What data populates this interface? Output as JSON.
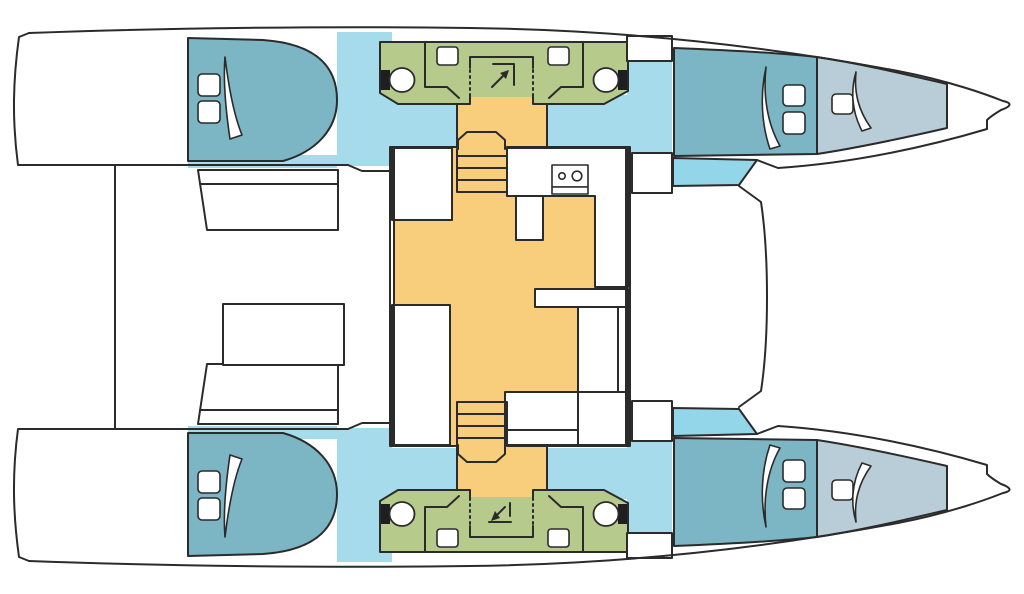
{
  "colors": {
    "background": "#ffffff",
    "line": "#2b2b2b",
    "white": "#ffffff",
    "bed": "#7cb5c4",
    "cabin_floor": "#a6dbec",
    "cabin_floor_bright": "#93d6e9",
    "forepeak": "#b8cdd7",
    "bathroom": "#b6ca8c",
    "salon_floor": "#f8ce7d",
    "toilet_tank": "#1f1f1f"
  }
}
